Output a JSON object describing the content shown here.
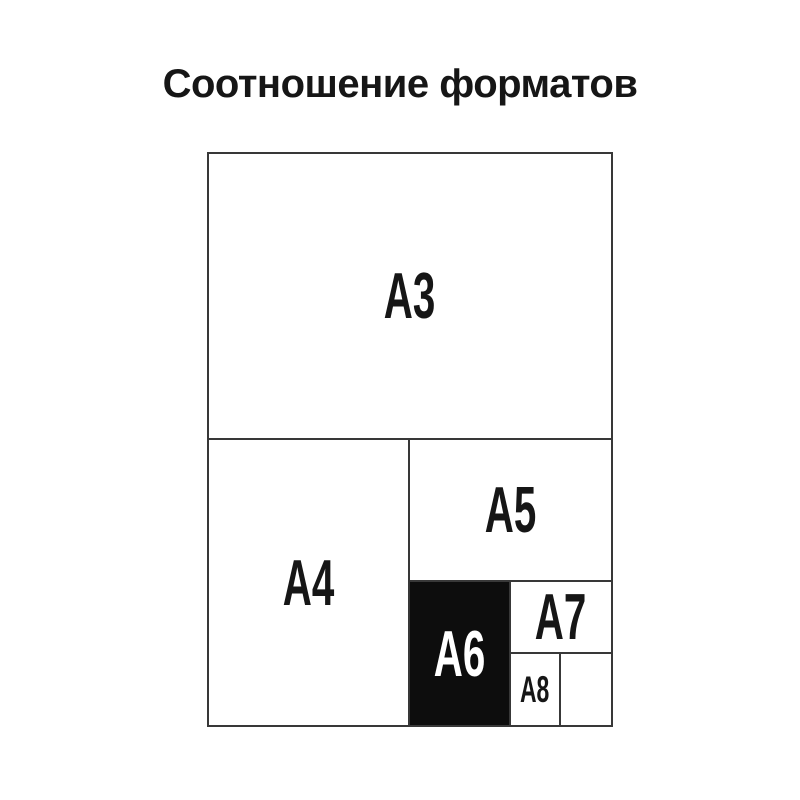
{
  "title": "Соотношение форматов",
  "diagram": {
    "type": "nested-paper-format-size-comparison",
    "labels": {
      "a3": "A3",
      "a4": "A4",
      "a5": "A5",
      "a6": "A6",
      "a7": "A7",
      "a8": "A8"
    },
    "highlighted_format": "A6",
    "colors": {
      "background": "#ffffff",
      "line": "#383838",
      "label_text": "#161616",
      "highlight_fill": "#0d0d0d",
      "highlight_text": "#ffffff"
    }
  }
}
